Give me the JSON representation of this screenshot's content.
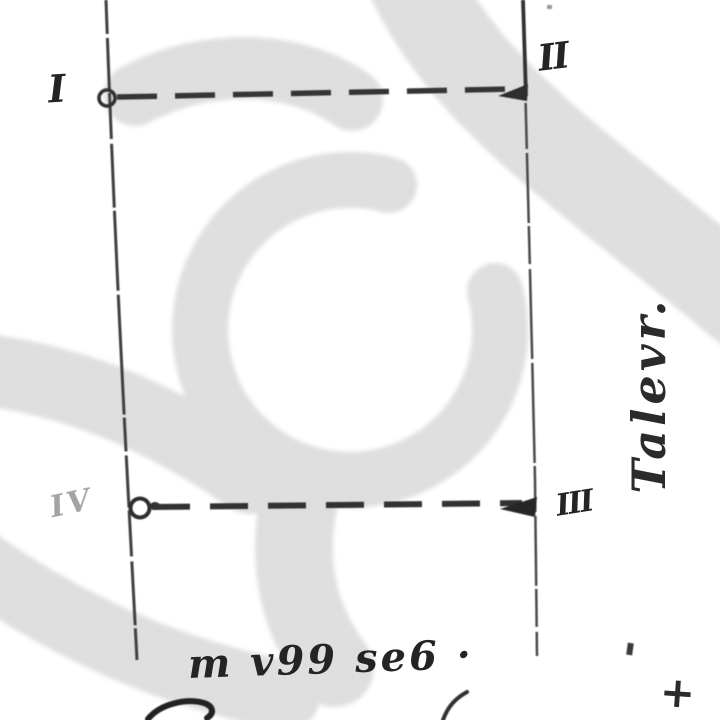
{
  "palette": {
    "paper": "#ffffff",
    "ink": "#2e2e2e",
    "label_ink": "#242424",
    "watermark": "#e2e2e2",
    "watermark_dot": "#d1d1d1"
  },
  "sketch": {
    "corner_labels": {
      "top_left": "I",
      "top_right": "II",
      "bottom_right": "III",
      "bottom_left": "IV"
    },
    "side_label": "Talevr.",
    "bottom_caption": "m v99 se6 ·",
    "cross_mark": "+"
  }
}
